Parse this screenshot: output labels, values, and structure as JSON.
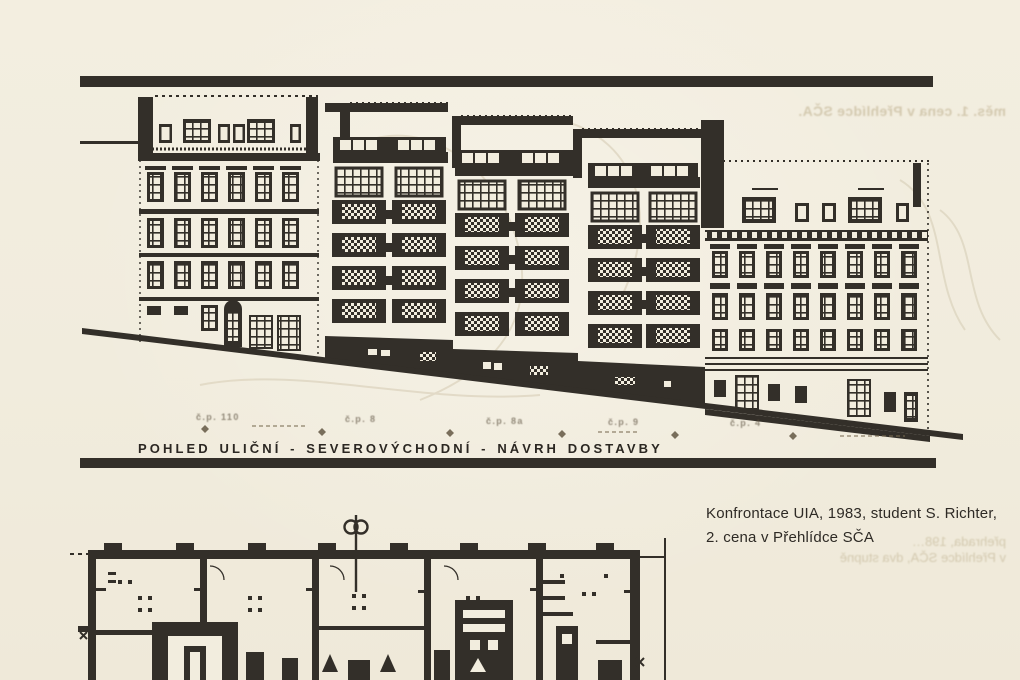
{
  "page": {
    "background_color": "#f2edde",
    "ink_color": "#332f29",
    "kind": "scanned architecture publication page"
  },
  "elevation": {
    "caption": "POHLED ULIČNÍ - SEVEROVÝCHODNÍ - NÁVRH DOSTAVBY",
    "house_labels": [
      "č.p. 110",
      "č.p. 8",
      "č.p. 8a",
      "č.p. 9",
      "č.p. 4"
    ]
  },
  "annotation": {
    "line1": "Konfrontace UIA, 1983, student S. Richter,",
    "line2": "2. cena v Přehlídce SČA"
  },
  "bleedthrough": {
    "top_right": "měs. 1. cena v Přehlídce SČA.",
    "mid_right_1": "přehrada, 198…",
    "mid_right_2": "v Přehlídce SČA, dva stupně"
  }
}
